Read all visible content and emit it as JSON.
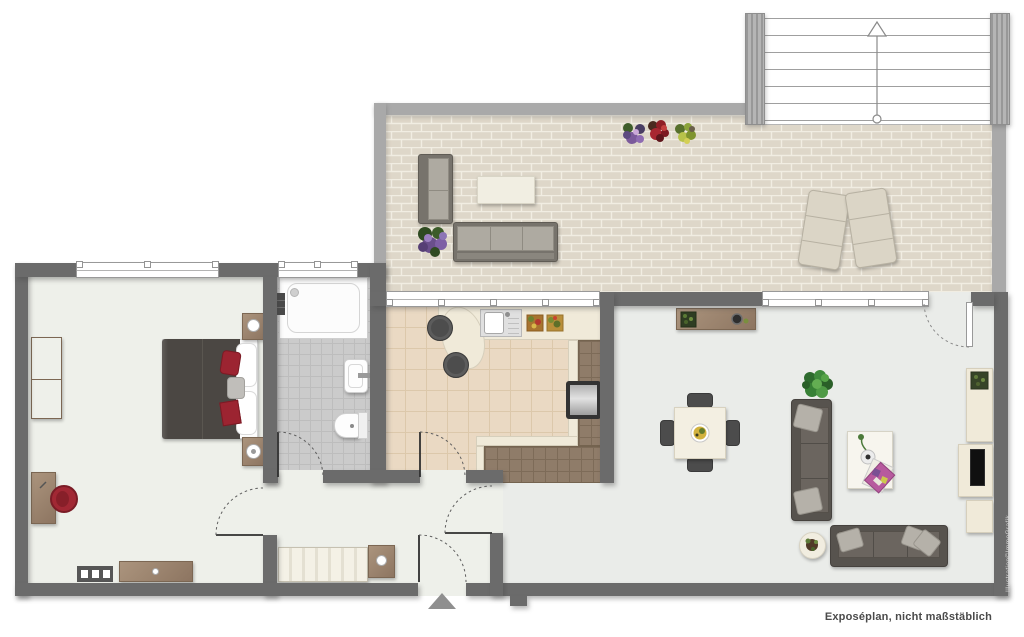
{
  "annotations": {
    "caption": "Exposéplan, nicht maßstäblich",
    "credit": "Illustration©ImmoGrafik"
  },
  "symbols": {
    "stair_direction_icon": "arrow-up",
    "entrance_marker_icon": "triangle-up",
    "door_swing_icon": "quarter-arc-dotted"
  },
  "palette": {
    "wall_dark": "#6b6b6b",
    "wall_light": "#a9a9a9",
    "bedroom_hall_floor": "#eef0ea",
    "living_floor": "#eaece9",
    "bath_tile": "#cbcbcb",
    "kitchen_tile": "#ead9c3",
    "counter_tile_brown": "#8f7c69",
    "counter_cream": "#f0ead9",
    "terrace_brick": "#ded7c9",
    "wood": "#a08a73",
    "sofa_dark": "#57534e",
    "cushion_light": "#b5b1a9",
    "accent_red": "#a12834",
    "plant_green": "#3f8a3c"
  },
  "rooms": [
    {
      "id": "terrace"
    },
    {
      "id": "staircase"
    },
    {
      "id": "bedroom"
    },
    {
      "id": "bathroom"
    },
    {
      "id": "kitchen"
    },
    {
      "id": "hallway"
    },
    {
      "id": "living-dining-room"
    }
  ],
  "furniture": [
    "outdoor-sofa-set",
    "outdoor-coffee-table",
    "sun-loungers",
    "flower-pots",
    "double-bed",
    "nightstands",
    "wardrobe",
    "desk",
    "red-chair",
    "dresser",
    "radiator",
    "bathtub",
    "wash-basin",
    "toilet",
    "kitchen-counter",
    "sink",
    "stove",
    "bar-counter",
    "bar-stools",
    "hall-closet",
    "hall-cabinet",
    "dining-table",
    "dining-chairs",
    "sofa",
    "couch",
    "coffee-table",
    "side-table",
    "tv-sideboard",
    "tv",
    "plants"
  ]
}
